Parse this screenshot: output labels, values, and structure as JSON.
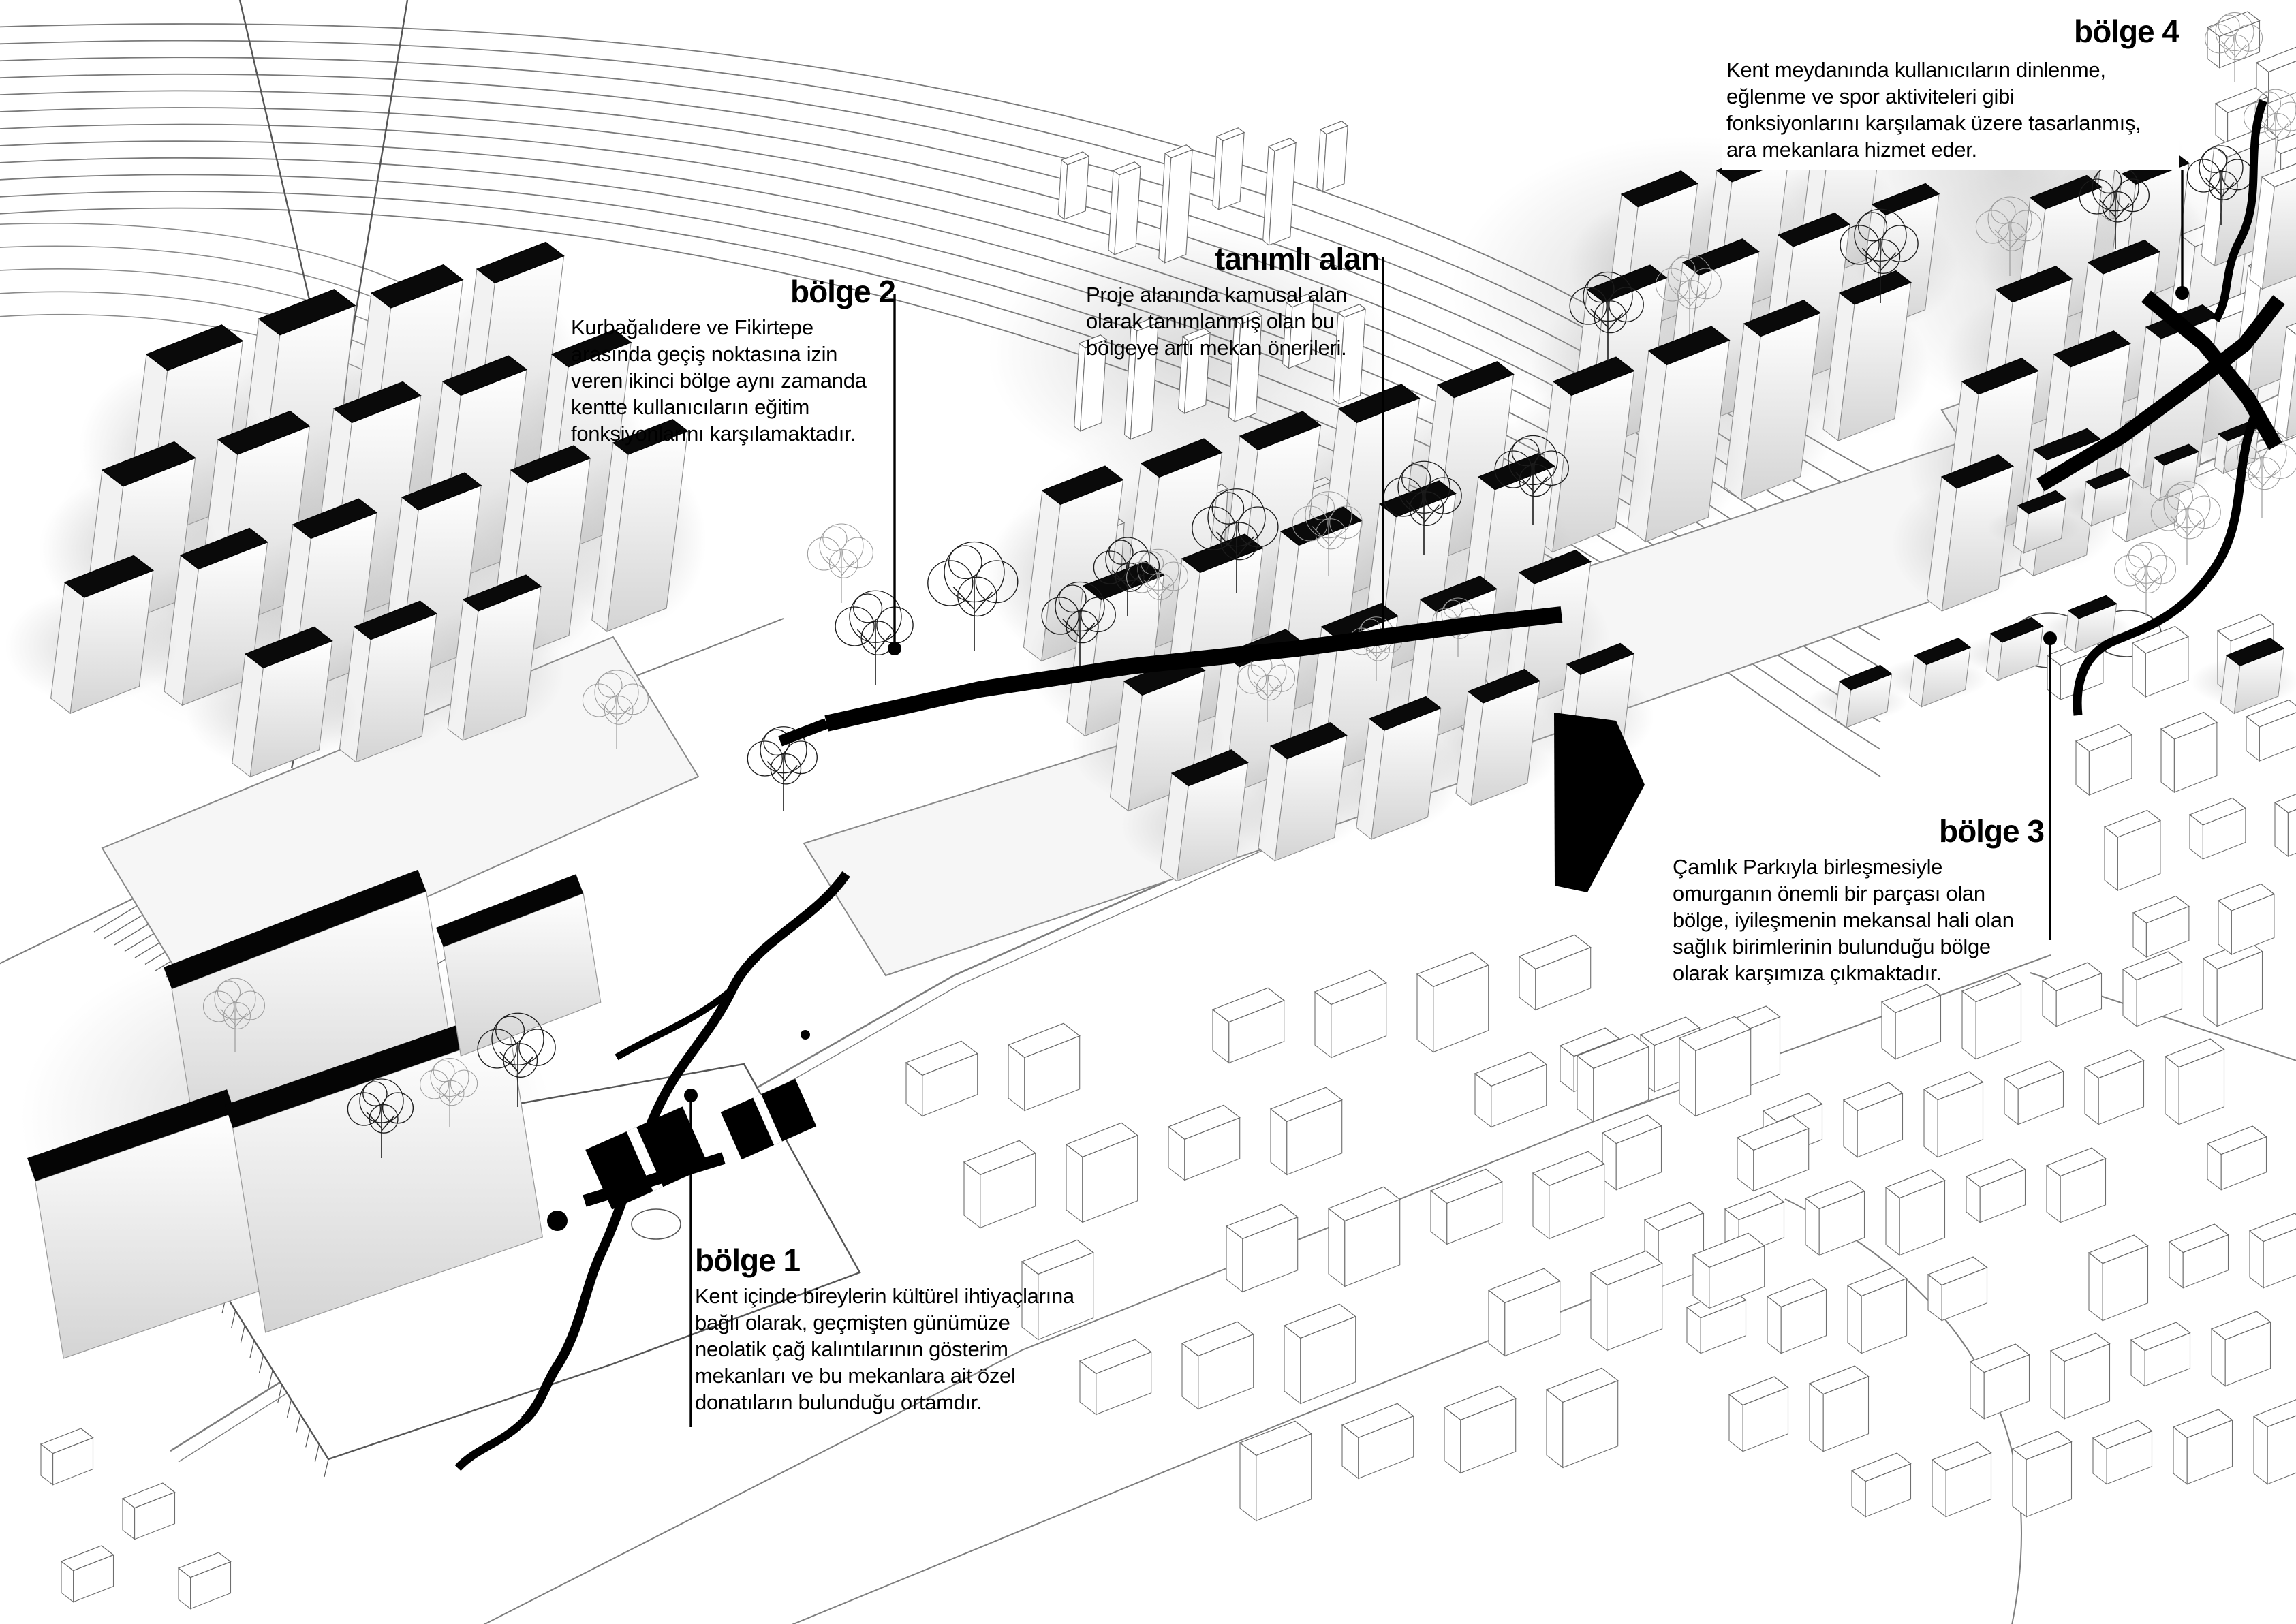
{
  "colors": {
    "ink": "#000000",
    "paper": "#ffffff"
  },
  "annotations": {
    "bolge1": {
      "title": "bölge 1",
      "body": [
        "Kent içinde bireylerin kültürel ihtiyaçlarına",
        "bağlı olarak, geçmişten günümüze",
        "neolatik çağ kalıntılarının gösterim",
        "mekanları ve bu mekanlara ait özel",
        "donatıların bulunduğu ortamdır."
      ]
    },
    "bolge2": {
      "title": "bölge 2",
      "body": [
        "Kurbağalıdere ve Fikirtepe",
        "arasında geçiş noktasına izin",
        "veren ikinci bölge aynı zamanda",
        "kentte kullanıcıların eğitim",
        "fonksiyonlarını karşılamaktadır."
      ]
    },
    "bolge3": {
      "title": "bölge 3",
      "body": [
        "Çamlık Parkıyla birleşmesiyle",
        "omurganın önemli bir parçası olan",
        "bölge, iyileşmenin mekansal hali olan",
        "sağlık birimlerinin bulunduğu bölge",
        "olarak karşımıza çıkmaktadır."
      ]
    },
    "bolge4": {
      "title": "bölge 4",
      "body": [
        "Kent meydanında kullanıcıların dinlenme,",
        "eğlenme ve spor aktiviteleri gibi",
        "fonksiyonlarını karşılamak üzere tasarlanmış,",
        "ara mekanlara hizmet eder."
      ]
    },
    "tanimli_alan": {
      "title": "tanımlı alan",
      "body": [
        "Proje alanında kamusal alan",
        "olarak tanımlanmış olan bu",
        "bölgeye artı mekan önerileri."
      ]
    }
  }
}
